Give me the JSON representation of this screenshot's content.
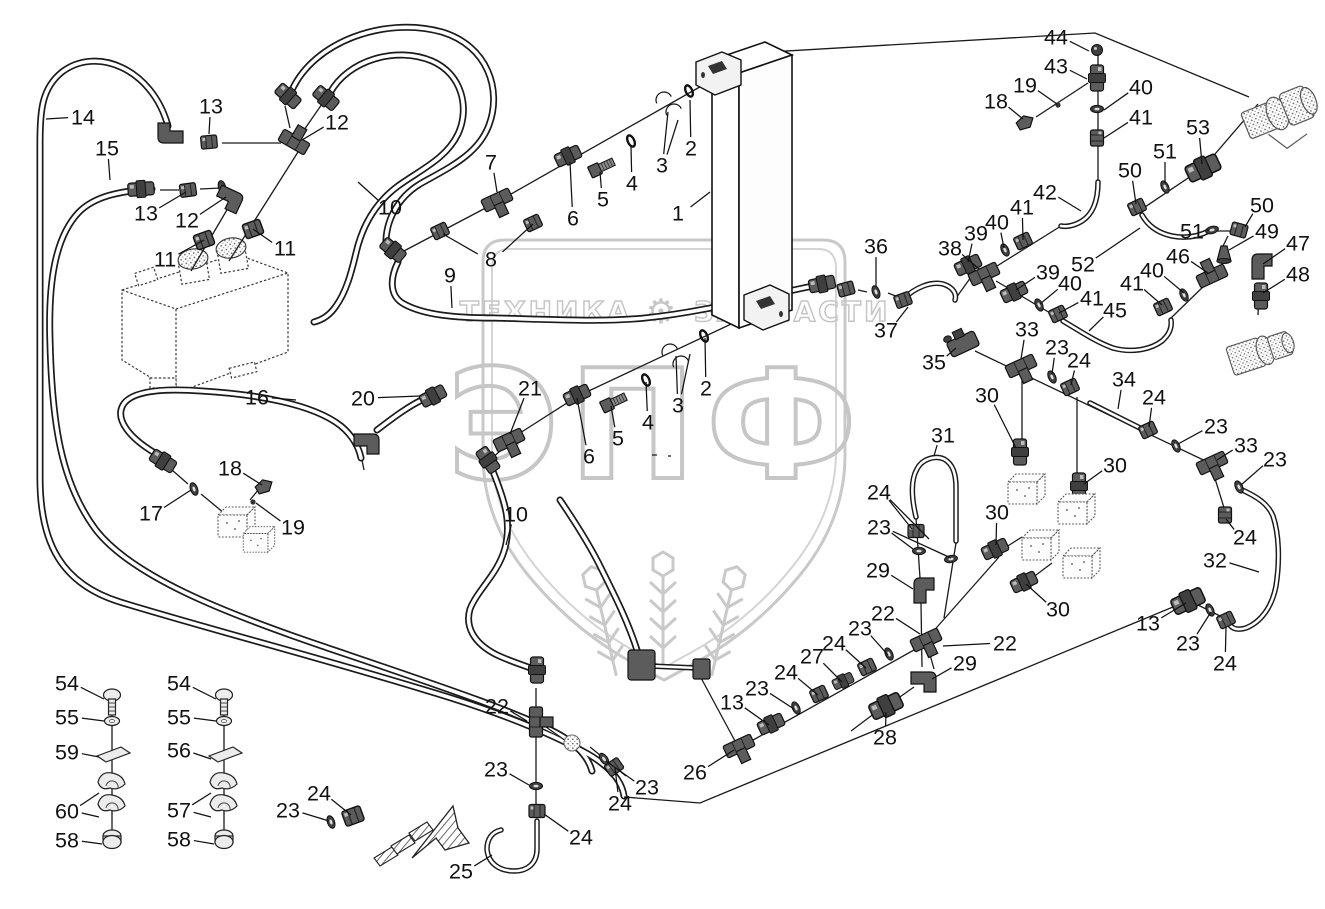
{
  "meta": {
    "width": 1325,
    "height": 909,
    "background": "#ffffff",
    "ink_color": "#1a1a1a",
    "watermark_color": "#c9c9c9"
  },
  "watermark": {
    "brand": "ЭПФ",
    "tagline_left": "ТЕХНИКА",
    "gear": "⚙",
    "tagline_right": "ЗАПЧАСТИ"
  },
  "callouts": [
    [
      "14",
      83,
      117,
      46,
      119
    ],
    [
      "13",
      211,
      106,
      209,
      134
    ],
    [
      "12",
      337,
      122,
      302,
      140
    ],
    [
      "15",
      107,
      148,
      110,
      180
    ],
    [
      "13",
      146,
      213,
      186,
      192
    ],
    [
      "12",
      187,
      220,
      226,
      197
    ],
    [
      "11",
      165,
      259,
      204,
      240
    ],
    [
      "11",
      285,
      248,
      253,
      229
    ],
    [
      "10",
      390,
      207,
      358,
      182
    ],
    [
      "7",
      491,
      162,
      497,
      192
    ],
    [
      "8",
      491,
      259,
      443,
      234
    ],
    [
      "9",
      450,
      275,
      452,
      308
    ],
    [
      "6",
      573,
      218,
      570,
      162
    ],
    [
      "5",
      603,
      199,
      600,
      172
    ],
    [
      "4",
      632,
      183,
      631,
      146
    ],
    [
      "3",
      662,
      165,
      668,
      112
    ],
    [
      "2",
      691,
      148,
      690,
      100
    ],
    [
      "1",
      678,
      213,
      710,
      192
    ],
    [
      "16",
      257,
      397,
      296,
      400
    ],
    [
      "20",
      363,
      398,
      420,
      396
    ],
    [
      "17",
      151,
      513,
      191,
      490
    ],
    [
      "18",
      230,
      468,
      262,
      485
    ],
    [
      "19",
      293,
      527,
      256,
      503
    ],
    [
      "21",
      530,
      388,
      510,
      434
    ],
    [
      "6",
      589,
      456,
      577,
      398
    ],
    [
      "5",
      618,
      438,
      611,
      406
    ],
    [
      "4",
      648,
      422,
      646,
      382
    ],
    [
      "3",
      678,
      405,
      676,
      356
    ],
    [
      "2",
      706,
      388,
      705,
      338
    ],
    [
      "10",
      516,
      514,
      506,
      545
    ],
    [
      "22",
      497,
      706,
      527,
      721
    ],
    [
      "23",
      496,
      769,
      529,
      785
    ],
    [
      "24",
      581,
      837,
      544,
      814
    ],
    [
      "25",
      461,
      871,
      492,
      855
    ],
    [
      "23",
      647,
      787,
      606,
      761
    ],
    [
      "24",
      620,
      803,
      615,
      768
    ],
    [
      "26",
      695,
      772,
      734,
      750
    ],
    [
      "13",
      732,
      702,
      769,
      725
    ],
    [
      "23",
      757,
      688,
      794,
      709
    ],
    [
      "24",
      786,
      672,
      818,
      695
    ],
    [
      "27",
      812,
      656,
      842,
      682
    ],
    [
      "24",
      834,
      643,
      866,
      668
    ],
    [
      "23",
      860,
      628,
      888,
      655
    ],
    [
      "22",
      883,
      613,
      920,
      634
    ],
    [
      "28",
      885,
      737,
      886,
      712
    ],
    [
      "29",
      965,
      663,
      932,
      679
    ],
    [
      "22",
      1005,
      643,
      943,
      646
    ],
    [
      "29",
      878,
      570,
      913,
      589
    ],
    [
      "24",
      879,
      492,
      912,
      529
    ],
    [
      "23",
      879,
      527,
      913,
      549
    ],
    [
      "31",
      943,
      435,
      934,
      456
    ],
    [
      "30",
      987,
      395,
      1016,
      448
    ],
    [
      "30",
      1115,
      465,
      1084,
      484
    ],
    [
      "30",
      997,
      512,
      996,
      545
    ],
    [
      "30",
      1058,
      609,
      1026,
      584
    ],
    [
      "35",
      934,
      362,
      956,
      348
    ],
    [
      "33",
      1027,
      329,
      1021,
      359
    ],
    [
      "23",
      1057,
      347,
      1052,
      374
    ],
    [
      "24",
      1079,
      360,
      1071,
      385
    ],
    [
      "34",
      1124,
      379,
      1118,
      409
    ],
    [
      "24",
      1154,
      397,
      1149,
      427
    ],
    [
      "23",
      1216,
      426,
      1178,
      444
    ],
    [
      "33",
      1246,
      445,
      1217,
      460
    ],
    [
      "23",
      1275,
      459,
      1241,
      485
    ],
    [
      "24",
      1245,
      537,
      1226,
      519
    ],
    [
      "32",
      1215,
      560,
      1259,
      572
    ],
    [
      "13",
      1148,
      623,
      1186,
      603
    ],
    [
      "23",
      1188,
      643,
      1211,
      612
    ],
    [
      "24",
      1225,
      663,
      1226,
      627
    ],
    [
      "36",
      876,
      246,
      876,
      286
    ],
    [
      "37",
      886,
      330,
      908,
      307
    ],
    [
      "38",
      950,
      248,
      979,
      269
    ],
    [
      "39",
      976,
      233,
      968,
      262
    ],
    [
      "40",
      997,
      222,
      1004,
      248
    ],
    [
      "41",
      1022,
      207,
      1023,
      240
    ],
    [
      "39",
      1048,
      272,
      1016,
      290
    ],
    [
      "40",
      1070,
      283,
      1040,
      304
    ],
    [
      "41",
      1092,
      298,
      1059,
      313
    ],
    [
      "45",
      1115,
      310,
      1089,
      331
    ],
    [
      "52",
      1083,
      264,
      1140,
      228
    ],
    [
      "42",
      1045,
      192,
      1081,
      211
    ],
    [
      "44",
      1056,
      37,
      1089,
      51
    ],
    [
      "43",
      1056,
      66,
      1087,
      79
    ],
    [
      "19",
      1025,
      85,
      1057,
      104
    ],
    [
      "18",
      996,
      101,
      1023,
      119
    ],
    [
      "40",
      1141,
      87,
      1104,
      110
    ],
    [
      "41",
      1141,
      117,
      1104,
      138
    ],
    [
      "53",
      1198,
      127,
      1202,
      164
    ],
    [
      "51",
      1165,
      151,
      1165,
      183
    ],
    [
      "50",
      1130,
      170,
      1136,
      204
    ],
    [
      "50",
      1262,
      205,
      1245,
      227
    ],
    [
      "51",
      1192,
      231,
      1209,
      230
    ],
    [
      "49",
      1267,
      231,
      1229,
      250
    ],
    [
      "46",
      1178,
      256,
      1208,
      273
    ],
    [
      "47",
      1298,
      243,
      1263,
      264
    ],
    [
      "48",
      1298,
      274,
      1263,
      293
    ],
    [
      "40",
      1152,
      270,
      1184,
      293
    ],
    [
      "41",
      1132,
      283,
      1162,
      305
    ],
    [
      "54",
      67,
      683,
      104,
      699
    ],
    [
      "55",
      67,
      717,
      104,
      721
    ],
    [
      "59",
      67,
      752,
      99,
      757
    ],
    [
      "60",
      67,
      811,
      99,
      793
    ],
    [
      "58",
      67,
      840,
      102,
      844
    ],
    [
      "54",
      179,
      683,
      216,
      699
    ],
    [
      "55",
      179,
      717,
      216,
      721
    ],
    [
      "56",
      179,
      750,
      211,
      759
    ],
    [
      "57",
      179,
      810,
      211,
      793
    ],
    [
      "58",
      179,
      839,
      214,
      844
    ],
    [
      "23",
      288,
      810,
      329,
      821
    ],
    [
      "24",
      319,
      793,
      351,
      815
    ]
  ],
  "extra_leaders": [
    [
      491,
      259,
      533,
      224
    ],
    [
      662,
      165,
      678,
      120
    ],
    [
      678,
      405,
      690,
      354
    ],
    [
      67,
      811,
      99,
      817
    ],
    [
      179,
      810,
      211,
      817
    ],
    [
      879,
      492,
      929,
      539
    ],
    [
      879,
      527,
      951,
      558
    ]
  ]
}
